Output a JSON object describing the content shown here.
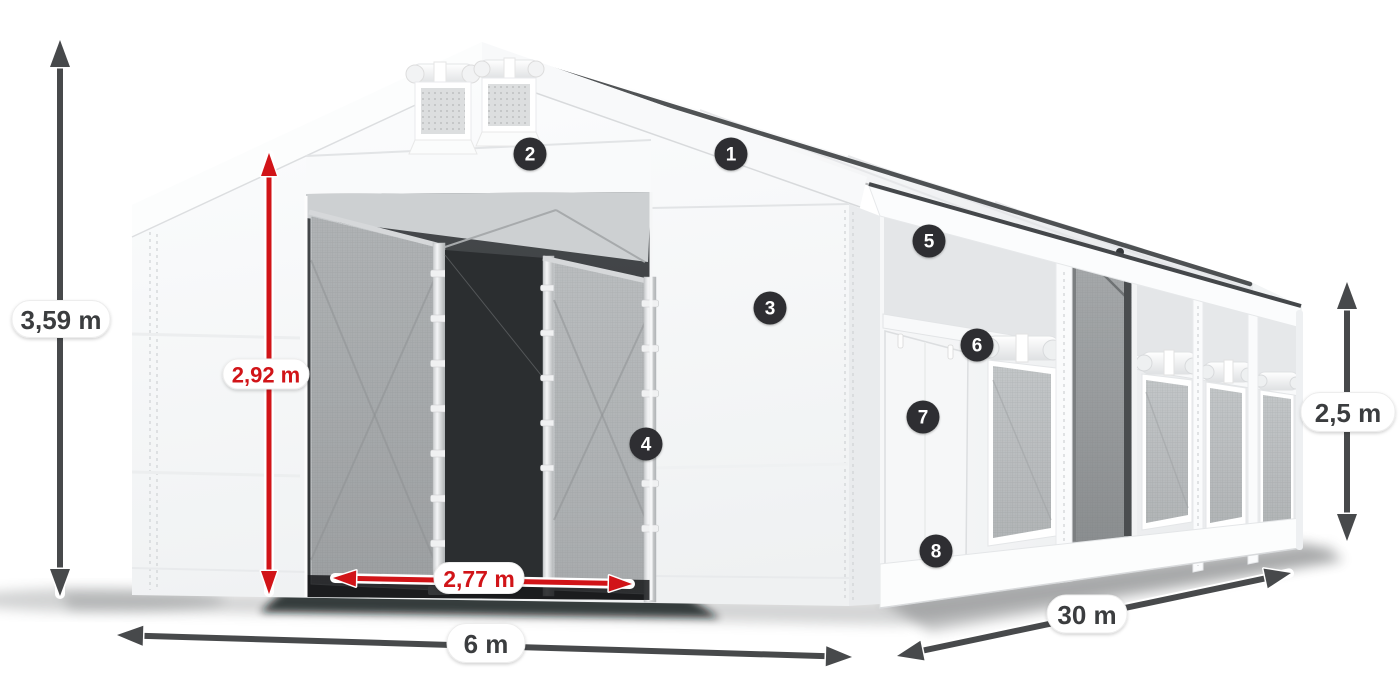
{
  "diagram": {
    "kind": "product-dimension-diagram",
    "subject": "white storage tent with numbered feature callouts"
  },
  "dimensions": {
    "total_height": "3,59 m",
    "entrance_height": "2,92 m",
    "entrance_width": "2,77 m",
    "front_width": "6 m",
    "length": "30 m",
    "side_wall_height": "2,5 m"
  },
  "callouts": [
    {
      "number": "1"
    },
    {
      "number": "2"
    },
    {
      "number": "3"
    },
    {
      "number": "4"
    },
    {
      "number": "5"
    },
    {
      "number": "6"
    },
    {
      "number": "7"
    },
    {
      "number": "8"
    }
  ],
  "colors": {
    "background": "#ffffff",
    "dimension_dark": "#47494b",
    "dimension_red": "#d11418",
    "label_dark": "#3b3d3f",
    "badge_background": "#2d2f30",
    "badge_text": "#ffffff",
    "pill_background": "#ffffff"
  }
}
